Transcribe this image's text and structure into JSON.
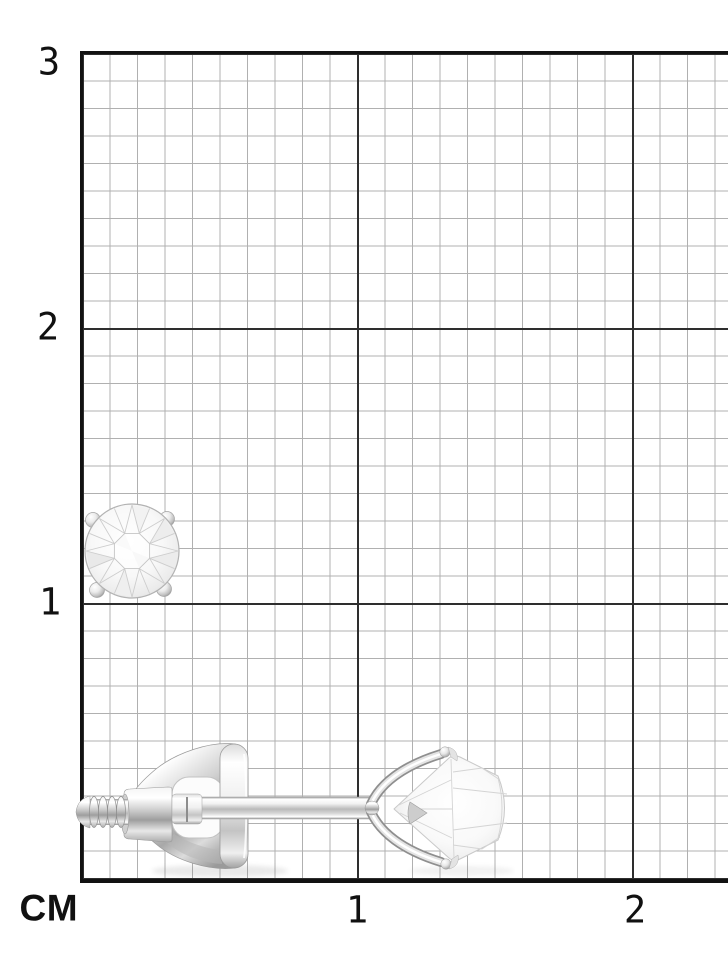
{
  "ruler": {
    "unit_label": "СМ",
    "y_labels": [
      "3",
      "2",
      "1"
    ],
    "x_labels": [
      "1",
      "2"
    ],
    "minor_divisions_per_cm": 10,
    "colors": {
      "background": "#ffffff",
      "minor_line": "#b0b0b0",
      "major_line": "#2e2e2e",
      "border_line": "#121212",
      "label_text": "#111111"
    }
  },
  "images": {
    "front_view": "diamond-stud-earring-front",
    "side_view": "diamond-stud-earring-side-with-screw-back"
  }
}
